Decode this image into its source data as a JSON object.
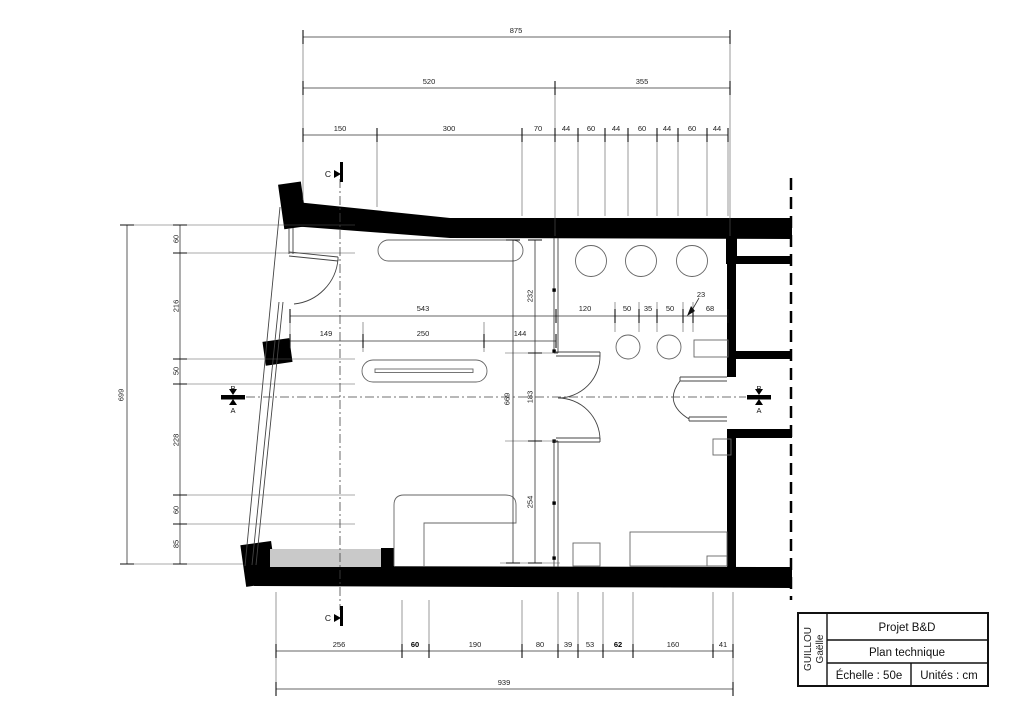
{
  "colors": {
    "wall_fill": "#000000",
    "mat_fill": "#c9c9c9",
    "line": "#333333",
    "background": "#ffffff"
  },
  "title_block": {
    "author_last": "GUILLOU",
    "author_first": "Gaëlle",
    "project": "Projet B&D",
    "drawing_title": "Plan technique",
    "scale": "Échelle : 50e",
    "units": "Unités : cm"
  },
  "section_markers": {
    "top": "C",
    "bottom": "C",
    "left_top": "B",
    "left_bottom": "A",
    "right_top": "B",
    "right_bottom": "A"
  },
  "dimensions": {
    "top": {
      "total": "875",
      "row2": [
        "520",
        "355"
      ],
      "row3": [
        "150",
        "300",
        "70",
        "44",
        "60",
        "44",
        "60",
        "44",
        "60",
        "44"
      ]
    },
    "left": {
      "total": "699",
      "chain": [
        "60",
        "216",
        "50",
        "228",
        "60",
        "85"
      ]
    },
    "bottom": {
      "total": "939",
      "chain": [
        "256",
        "60",
        "190",
        "80",
        "39",
        "53",
        "62",
        "160",
        "41"
      ]
    },
    "interior": {
      "width_total": "543",
      "width_chain": [
        "149",
        "250",
        "144"
      ],
      "right_chain": [
        "120",
        "50",
        "35",
        "50",
        "68"
      ],
      "leader": "23",
      "height_total": "669",
      "height_chain": [
        "232",
        "183",
        "254"
      ]
    }
  }
}
